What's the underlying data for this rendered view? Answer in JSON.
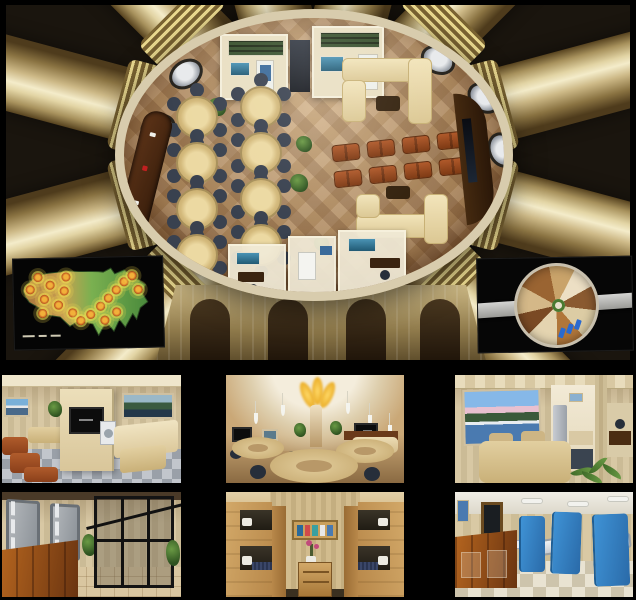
{
  "page": {
    "title": "Underground survival bunker concept renderings collage",
    "background": "#000000"
  },
  "colors": {
    "canvas_bg": "#000000",
    "gold_light": "#f4ecca",
    "gold_dark": "#7a6332",
    "dome_rim": "#d8ccad",
    "floor_a": "#c9a478",
    "floor_b": "#b8905f",
    "table_wood": "#d4ba7c",
    "chair_dark": "#39414f",
    "sofa_cream": "#dcc894",
    "seat_brown": "#b0592a",
    "bar_wood": "#371d0b",
    "wall_wood": "#d8c8a4",
    "floor_gray": "#9aa0a8",
    "vault_gray": "#8a9096",
    "cage_black": "#111111",
    "partition_blue": "#3f93d6",
    "plant_green": "#6a9a44",
    "glow_yellow": "#ffd968",
    "target_orange": "#f2b03a",
    "corridor_gray": "#d4d4d2",
    "desk_cherry": "#6a3410"
  },
  "main_view": {
    "name": "bunker-hub-aerial-cutaway",
    "subject": "circular community dome with radiating gold corridor tubes, dining tables, lounge sofas, card bar and perimeter cabins",
    "corridor_tube_count": 12,
    "dining_table_count": 8,
    "loveseat_count": 8,
    "porthole_count": 5
  },
  "insets": {
    "map": {
      "name": "us-target-zone-map",
      "subject": "United States relief map with concentric blast-target rings",
      "target_count": 19,
      "background": "#050505"
    },
    "floorplan": {
      "name": "bunker-floorplan-top-view",
      "subject": "top-down circular floor plan crossed by a gray corridor",
      "background": "#060606"
    }
  },
  "gallery": {
    "rows": [
      {
        "panels": [
          {
            "name": "lounge-tv-room",
            "subject": "lounge with TV partition, brown armchairs, cream banquette, laundry nook"
          },
          {
            "name": "dining-hall-dome",
            "subject": "dining hall with glowing petal dome ceiling, pendant lights, round tables"
          },
          {
            "name": "dining-room-artwork",
            "subject": "dining room with mountain-lake artwork, wooden table, refrigerator"
          }
        ]
      },
      {
        "panels": [
          {
            "name": "entry-vault-room",
            "subject": "entry with gray blast doors, cherry desk and black security cage"
          },
          {
            "name": "bunk-room",
            "subject": "symmetric wooden bunk beds with center shelf and dresser"
          },
          {
            "name": "medical-bay",
            "subject": "medical bay with cherry desk, blue privacy screens and hospital beds"
          }
        ]
      }
    ]
  }
}
